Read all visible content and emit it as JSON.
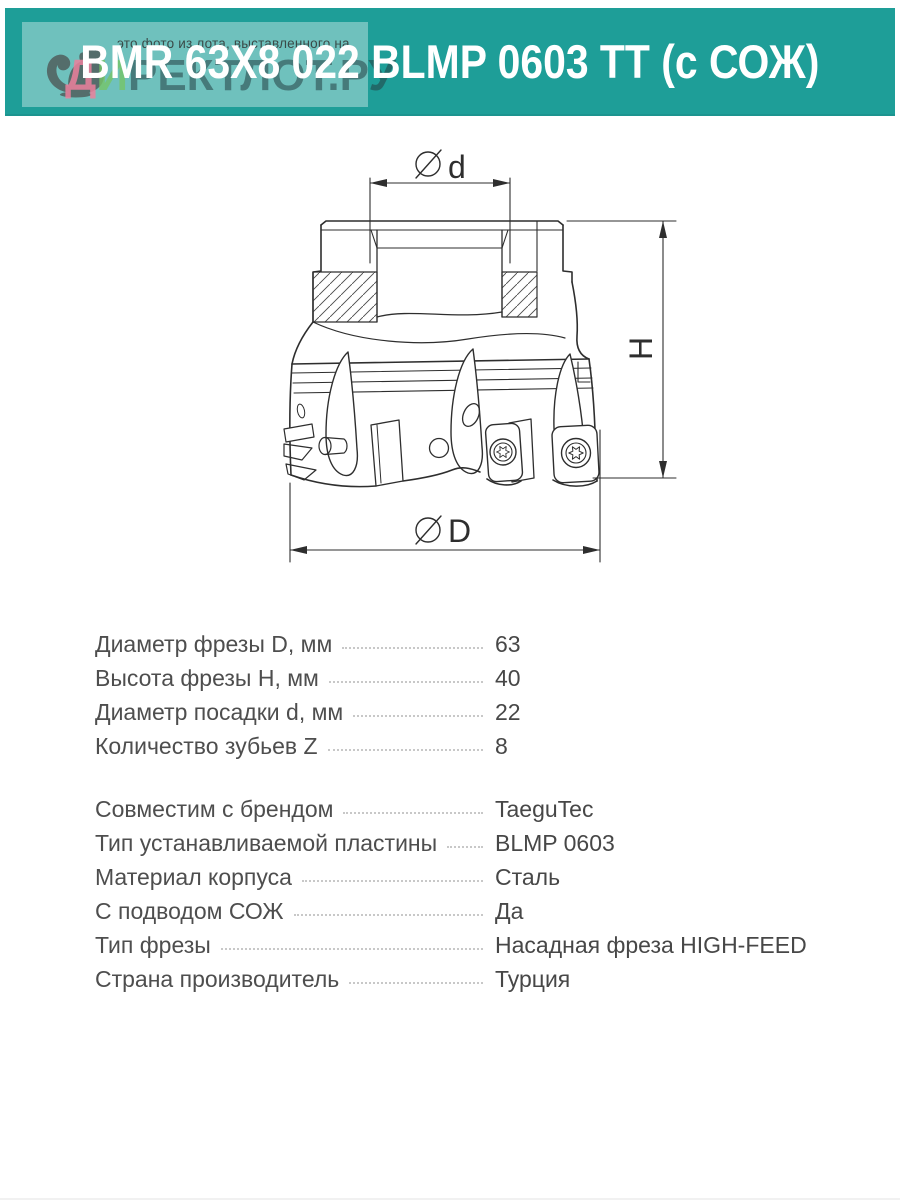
{
  "colors": {
    "brand_teal": "#1E9E98",
    "overlay_white": "rgba(255,255,255,0.36)",
    "title_white": "#FFFFFF",
    "text_gray": "#4C4C4C",
    "drawing_line": "#2E2E2E"
  },
  "header": {
    "title": "BMR 63X8 022 BLMP 0603 TT (с СОЖ)",
    "watermark_note": "это фото из лота, выставленного на",
    "watermark_site_c1": "Д",
    "watermark_site_c2": "И",
    "watermark_site_rest": "РЕКТЛОТ.РУ",
    "watermark_site_full": "ДИРЕКТЛОТ.РУ",
    "mascot": "squirrel"
  },
  "drawing": {
    "type": "technical-drawing-face-mill-section",
    "dim_top_symbol": "∅",
    "dim_top_letter": "d",
    "dim_right_letter": "H",
    "dim_bottom_symbol": "∅",
    "dim_bottom_letter": "D"
  },
  "specs": {
    "block1": [
      {
        "label": "Диаметр фрезы D, мм",
        "value": "63"
      },
      {
        "label": "Высота фрезы H, мм",
        "value": "40"
      },
      {
        "label": "Диаметр посадки d, мм",
        "value": "22"
      },
      {
        "label": "Количество зубьев Z",
        "value": "8"
      }
    ],
    "block2": [
      {
        "label": "Совместим с брендом",
        "value": "TaeguTec"
      },
      {
        "label": "Тип устанавливаемой пластины",
        "value": "BLMP 0603"
      },
      {
        "label": "Материал корпуса",
        "value": "Сталь"
      },
      {
        "label": "С подводом СОЖ",
        "value": "Да"
      },
      {
        "label": "Тип фрезы",
        "value": "Насадная фреза HIGH-FEED"
      },
      {
        "label": "Страна производитель",
        "value": "Турция"
      }
    ]
  }
}
